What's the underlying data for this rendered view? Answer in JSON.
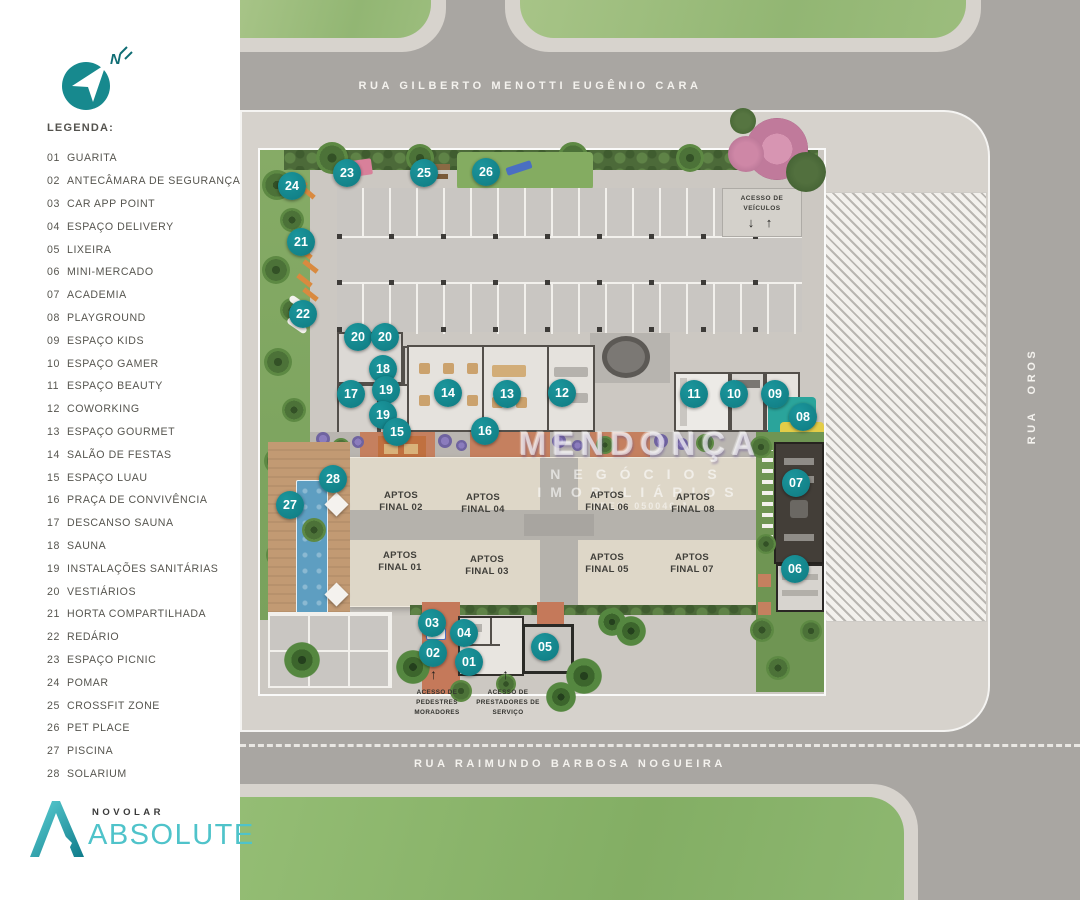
{
  "sidebar": {
    "north_label": "N",
    "legend_title": "LEGENDA:",
    "legend_items": [
      {
        "num": "01",
        "label": "GUARITA"
      },
      {
        "num": "02",
        "label": "ANTECÂMARA DE SEGURANÇA"
      },
      {
        "num": "03",
        "label": "CAR APP POINT"
      },
      {
        "num": "04",
        "label": "ESPAÇO DELIVERY"
      },
      {
        "num": "05",
        "label": "LIXEIRA"
      },
      {
        "num": "06",
        "label": "MINI-MERCADO"
      },
      {
        "num": "07",
        "label": "ACADEMIA"
      },
      {
        "num": "08",
        "label": "PLAYGROUND"
      },
      {
        "num": "09",
        "label": "ESPAÇO KIDS"
      },
      {
        "num": "10",
        "label": "ESPAÇO GAMER"
      },
      {
        "num": "11",
        "label": "ESPAÇO BEAUTY"
      },
      {
        "num": "12",
        "label": "COWORKING"
      },
      {
        "num": "13",
        "label": "ESPAÇO GOURMET"
      },
      {
        "num": "14",
        "label": "SALÃO DE FESTAS"
      },
      {
        "num": "15",
        "label": "ESPAÇO LUAU"
      },
      {
        "num": "16",
        "label": "PRAÇA DE CONVIVÊNCIA"
      },
      {
        "num": "17",
        "label": "DESCANSO SAUNA"
      },
      {
        "num": "18",
        "label": "SAUNA"
      },
      {
        "num": "19",
        "label": "INSTALAÇÕES SANITÁRIAS"
      },
      {
        "num": "20",
        "label": "VESTIÁRIOS"
      },
      {
        "num": "21",
        "label": "HORTA COMPARTILHADA"
      },
      {
        "num": "22",
        "label": "REDÁRIO"
      },
      {
        "num": "23",
        "label": "ESPAÇO PICNIC"
      },
      {
        "num": "24",
        "label": "POMAR"
      },
      {
        "num": "25",
        "label": "CROSSFIT ZONE"
      },
      {
        "num": "26",
        "label": "PET PLACE"
      },
      {
        "num": "27",
        "label": "PISCINA"
      },
      {
        "num": "28",
        "label": "SOLARIUM"
      }
    ],
    "logo": {
      "brand": "NOVOLAR",
      "name": "ABSOLUTE"
    }
  },
  "map": {
    "streets": {
      "top": "RUA GILBERTO MENOTTI EUGÊNIO CARA",
      "bottom": "RUA RAIMUNDO BARBOSA NOGUEIRA",
      "right": "RUA OROS"
    },
    "vehicle_access": {
      "label": "ACESSO DE VEÍCULOS",
      "arrows": "↓ ↑"
    },
    "pedestrian_access": {
      "arrow": "↑",
      "l1": "ACESSO DE",
      "l2": "PEDESTRES",
      "l3": "MORADORES"
    },
    "service_access": {
      "arrow": "↑",
      "l1": "ACESSO DE",
      "l2": "PRESTADORES DE",
      "l3": "SERVIÇO"
    },
    "watermark": {
      "name": "MENDONÇA",
      "line2": "NEGÓCIOS",
      "line3": "IMOBILIÁRIOS",
      "creci": "CRECI 050046-J"
    },
    "units": [
      {
        "top": "APTOS",
        "bottom": "FINAL 02",
        "x": 161,
        "y": 503
      },
      {
        "top": "APTOS",
        "bottom": "FINAL 04",
        "x": 243,
        "y": 505
      },
      {
        "top": "APTOS",
        "bottom": "FINAL 06",
        "x": 367,
        "y": 503
      },
      {
        "top": "APTOS",
        "bottom": "FINAL 08",
        "x": 453,
        "y": 505
      },
      {
        "top": "APTOS",
        "bottom": "FINAL 01",
        "x": 160,
        "y": 563
      },
      {
        "top": "APTOS",
        "bottom": "FINAL 03",
        "x": 247,
        "y": 567
      },
      {
        "top": "APTOS",
        "bottom": "FINAL 05",
        "x": 367,
        "y": 565
      },
      {
        "top": "APTOS",
        "bottom": "FINAL 07",
        "x": 452,
        "y": 565
      }
    ],
    "markers": [
      {
        "n": "24",
        "x": 52,
        "y": 186
      },
      {
        "n": "23",
        "x": 107,
        "y": 173
      },
      {
        "n": "25",
        "x": 184,
        "y": 173
      },
      {
        "n": "26",
        "x": 246,
        "y": 172
      },
      {
        "n": "21",
        "x": 61,
        "y": 242
      },
      {
        "n": "22",
        "x": 63,
        "y": 314
      },
      {
        "n": "20",
        "x": 118,
        "y": 337
      },
      {
        "n": "20",
        "x": 145,
        "y": 337
      },
      {
        "n": "18",
        "x": 143,
        "y": 369
      },
      {
        "n": "17",
        "x": 111,
        "y": 394
      },
      {
        "n": "19",
        "x": 146,
        "y": 390
      },
      {
        "n": "19",
        "x": 143,
        "y": 415
      },
      {
        "n": "14",
        "x": 208,
        "y": 393
      },
      {
        "n": "13",
        "x": 267,
        "y": 394
      },
      {
        "n": "12",
        "x": 322,
        "y": 393
      },
      {
        "n": "11",
        "x": 454,
        "y": 394
      },
      {
        "n": "10",
        "x": 494,
        "y": 394
      },
      {
        "n": "09",
        "x": 535,
        "y": 394
      },
      {
        "n": "08",
        "x": 563,
        "y": 417
      },
      {
        "n": "15",
        "x": 157,
        "y": 432
      },
      {
        "n": "16",
        "x": 245,
        "y": 431
      },
      {
        "n": "28",
        "x": 93,
        "y": 479
      },
      {
        "n": "27",
        "x": 50,
        "y": 505
      },
      {
        "n": "07",
        "x": 556,
        "y": 483
      },
      {
        "n": "06",
        "x": 555,
        "y": 569
      },
      {
        "n": "03",
        "x": 192,
        "y": 623
      },
      {
        "n": "04",
        "x": 224,
        "y": 633
      },
      {
        "n": "02",
        "x": 193,
        "y": 653
      },
      {
        "n": "01",
        "x": 229,
        "y": 662
      },
      {
        "n": "05",
        "x": 305,
        "y": 647
      }
    ],
    "colors": {
      "marker_teal": "#12828A",
      "logo_teal": "#4FC3CA",
      "road": "#A9A6A2",
      "sidewalk": "#D6D2CC",
      "grass": "#9CC17E",
      "building": "#DED7C8",
      "terracotta": "#C5805F",
      "pool_blue": "#5E9EC1"
    }
  }
}
